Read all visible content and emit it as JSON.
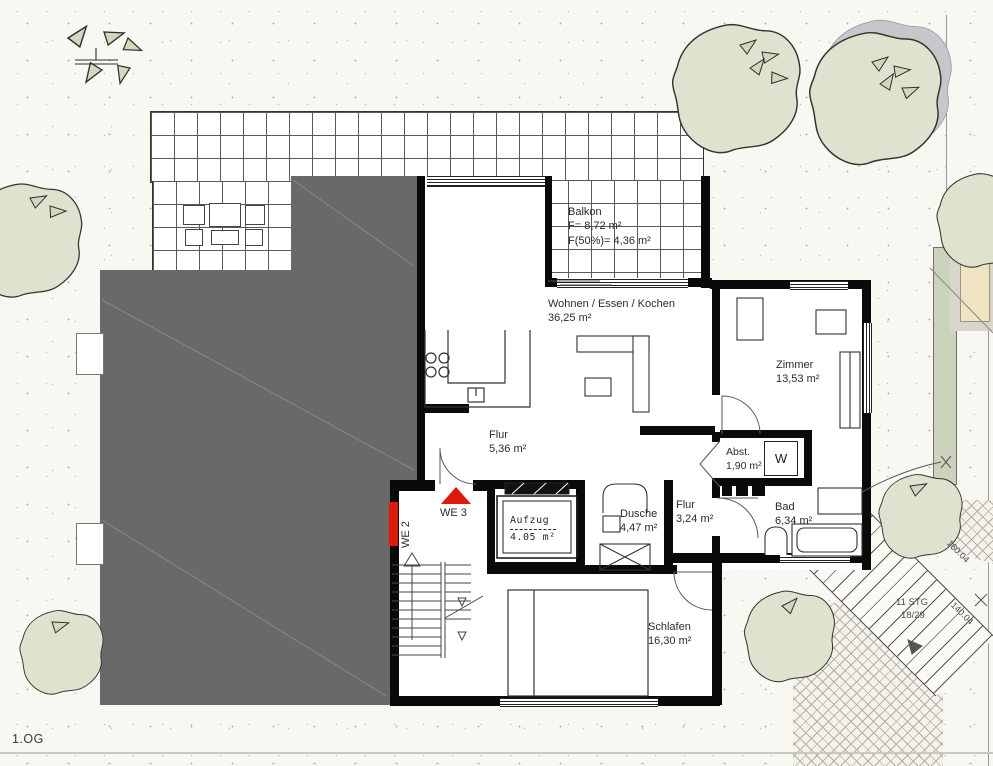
{
  "floor_label": "1.OG",
  "colors": {
    "wall": "#0a0a0a",
    "building_mass": "#696969",
    "tree_fill": "#dfe2cf",
    "entry_marker_red": "#e01808",
    "paper": "#f8f7f2"
  },
  "rooms": {
    "balkon": {
      "name": "Balkon",
      "line2": "F= 8,72 m²",
      "line3": "F(50%)= 4,36 m²"
    },
    "wohnen": {
      "name": "Wohnen / Essen / Kochen",
      "area": "36,25 m²"
    },
    "zimmer": {
      "name": "Zimmer",
      "area": "13,53 m²"
    },
    "flur": {
      "name": "Flur",
      "area": "5,36 m²"
    },
    "abstellraum": {
      "name": "Abst.",
      "area": "1,90 m²",
      "appliance": "W"
    },
    "aufzug": {
      "name": "Aufzug",
      "area": "4.05 m²"
    },
    "dusche": {
      "name": "Dusche",
      "area": "4,47 m²"
    },
    "flur2": {
      "name": "Flur",
      "area": "3,24 m²"
    },
    "bad": {
      "name": "Bad",
      "area": "6,34 m²"
    },
    "schlafen": {
      "name": "Schlafen",
      "area": "16,30 m²"
    }
  },
  "units": {
    "we2": "WE 2",
    "we3": "WE 3"
  },
  "site": {
    "stair_steps": "11 STG",
    "stair_ratio": "18/29",
    "dim_upper": "160.04",
    "dim_lower": "140.04"
  }
}
